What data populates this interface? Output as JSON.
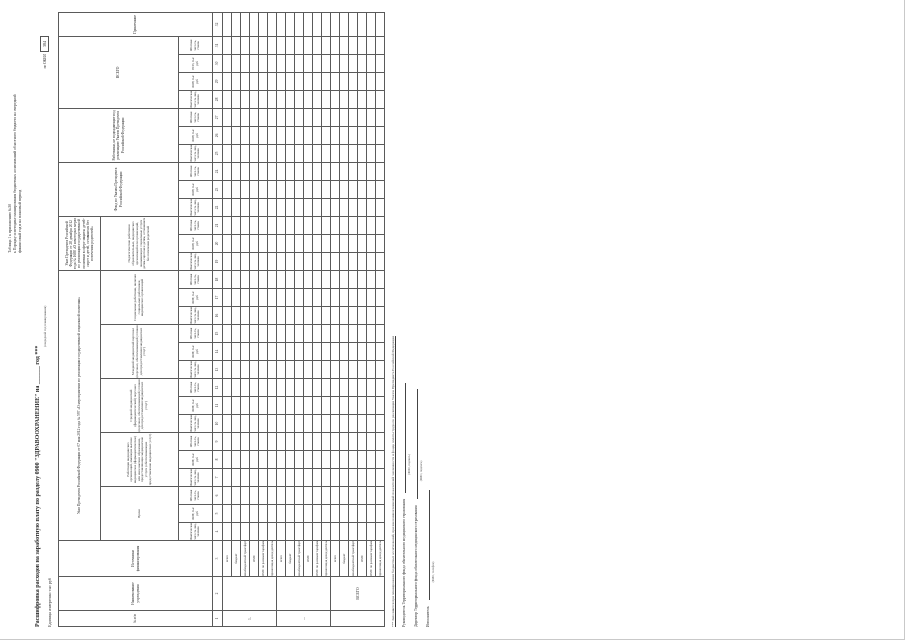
{
  "page": {
    "top_right_lines": [
      "Таблица 1 к приложению №30",
      "к Порядку и методике планирования бюджетных ассигнований областного бюджета на очередной",
      "финансовый год и на плановый период"
    ],
    "title": "Расшифровка расходов на заработную плату по разделу 0900 \"ЗДРАВООХРАНЕНИЕ\" на ______ год ***",
    "title_note": "(очередной год планирования)",
    "unit_line": "Единица измерения: тыс руб",
    "okei_label": "по ОКЕИ",
    "okei_value": "384",
    "footnote": "*** Заполняется при планировании бюджетных ассигнований, при внесении изменений показателей численности и фонда оплаты труда по реализации Указов Президента Российской Федерации",
    "signatures": [
      {
        "label": "Руководитель Территориального фонда обязательного медицинского страхования",
        "note": "(ФИО, подпись)"
      },
      {
        "label": "Директор Территориального фонда обязательного медицинского страхования",
        "note": "(ФИО, подпись)"
      },
      {
        "label": "Исполнитель",
        "note": "(ФИО, телефон)"
      }
    ]
  },
  "table": {
    "fixed_columns": [
      "№ п/п",
      "Наименование учреждения",
      "Источники финансирования"
    ],
    "group_597": "Указ Президента Российской Федерации от 07 мая 2012 года № 597 «О мероприятиях по реализации государственной социальной политики»",
    "group_597_categories": [
      "Врачи",
      "Работники медицинских организаций, имеющие высшее медицинское (фармацевтическое) или иное высшее образование, предоставляющие медицинские услуги (обеспечивающие предоставление медицинских услуг)",
      "Средний медицинский (фармацевтический) персонал (персонал, обеспечивающий условия для предоставления медицинских услуг)",
      "Младший медицинский персонал (персонал, обеспечивающий условия для предоставления медицинских услуг)",
      "Социальные работники, включая социальных работников медицинских организаций"
    ],
    "group_1688": "Указ Президента Российской Федерации от 28 декабря 2012 года № 1688 «О некоторых мерах по реализации государственной политики в сфере защиты детей-сирот и детей, оставшихся без попечения родителей»",
    "group_1688_categories": [
      "Педагогические работники образовательных, медицинских организаций или организаций, оказывающих социальные услуги детям-сиротам и детям, оставшимся без попечения родителей"
    ],
    "group_fond": "Фонд по Указам Президента Российской Федерации",
    "group_nonukaz": "Работники, не подпадающие под реализацию Указов Президента Российской Федерации",
    "group_total": "ВСЕГО",
    "note_column": "Примечание",
    "subcols": {
      "fact": "Фактическая числ-ть лиц, человек",
      "fot": "ФОТ, тыс руб",
      "esn": "ЕСН, тыс руб",
      "staff": "Штатная числ-ть, ставок"
    },
    "column_numbers": [
      "1",
      "2",
      "3",
      "4",
      "5",
      "6",
      "7",
      "8",
      "9",
      "10",
      "11",
      "12",
      "13",
      "14",
      "15",
      "16",
      "17",
      "18",
      "19",
      "20",
      "21",
      "22",
      "23",
      "24",
      "25",
      "26",
      "27",
      "28",
      "29",
      "30",
      "31",
      "32"
    ],
    "sources": [
      "всего",
      "бюджет",
      "межбюджетный трансферт ТФОМС из обл",
      "ОМС",
      "ОМС по разовым тарифам",
      "приносящая доход деятельность"
    ],
    "row_groups": [
      {
        "num": "1.",
        "name": ""
      },
      {
        "num": "...",
        "name": ""
      },
      {
        "num": "",
        "name": "ВСЕГО"
      }
    ]
  }
}
